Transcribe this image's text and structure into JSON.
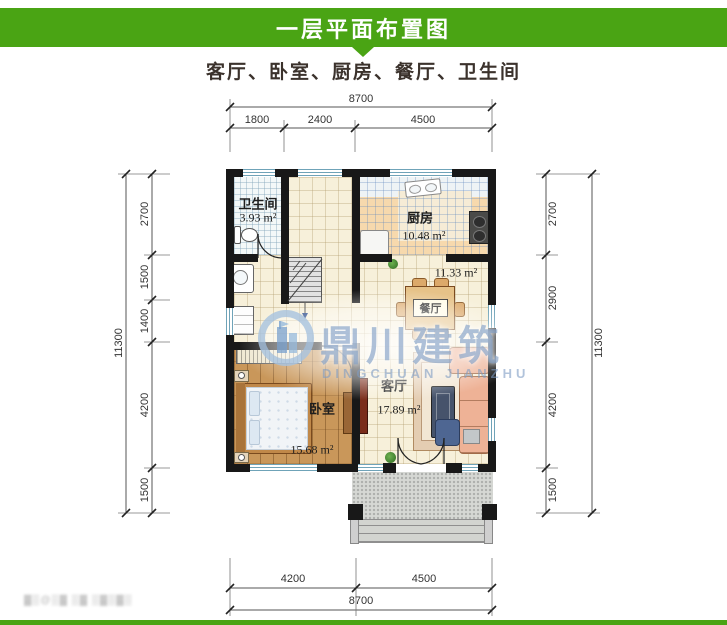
{
  "header": {
    "title": "一层平面布置图",
    "subtitle": "客厅、卧室、厨房、餐厅、卫生间"
  },
  "colors": {
    "accent_green": "#4aa414",
    "wall": "#181818",
    "watermark_blue": "#7d9bc3"
  },
  "rooms": [
    {
      "name": "卫生间",
      "area": "3.93 m²"
    },
    {
      "name": "厨房",
      "area": "10.48 m²"
    },
    {
      "name": "餐厅",
      "area": "11.33 m²"
    },
    {
      "name": "客厅",
      "area": "17.89 m²"
    },
    {
      "name": "卧室",
      "area": "15.68 m²"
    }
  ],
  "dimensions": {
    "top": {
      "total": "8700",
      "segments": [
        "1800",
        "2400",
        "4500"
      ]
    },
    "bottom": {
      "total": "8700",
      "segments": [
        "4200",
        "4500"
      ]
    },
    "left": {
      "total": "11300",
      "segments": [
        "2700",
        "1500",
        "1400",
        "4200",
        "1500"
      ]
    },
    "right": {
      "total": "11300",
      "segments": [
        "2700",
        "2900",
        "4200",
        "1500"
      ]
    }
  },
  "watermark": {
    "logo": "building-logo",
    "cn": "鼎川建筑",
    "en": "DINGCHUAN JIANZHU"
  },
  "footer": {
    "blurred_text": "▓▒@▒▓ ▒▓ ▒▓▒▓▒"
  }
}
